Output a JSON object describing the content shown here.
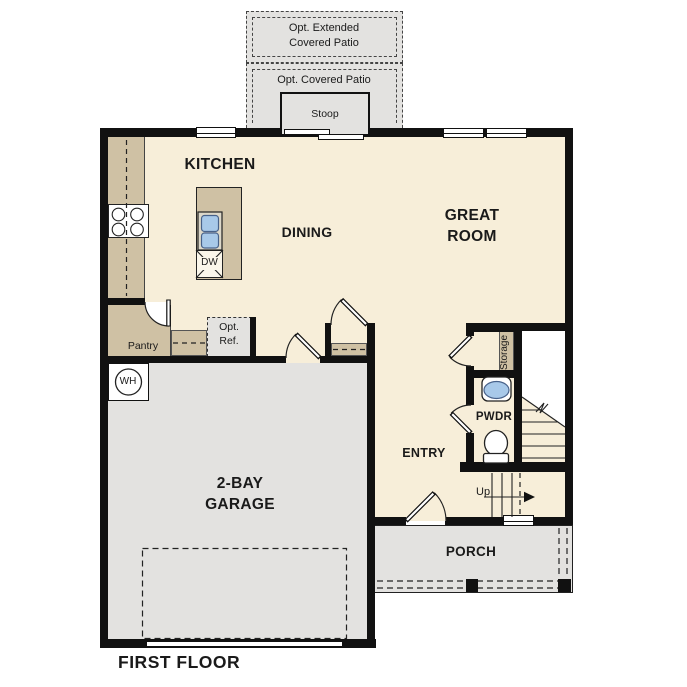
{
  "title": "FIRST FLOOR",
  "colors": {
    "floor": "#f7eed9",
    "paved": "#e3e2e0",
    "counter": "#cfc1a4",
    "wall": "#111111",
    "blue": "#a8c9e9"
  },
  "rooms": {
    "kitchen": "KITCHEN",
    "dining": "DINING",
    "great_room": "GREAT ROOM",
    "garage": "2-BAY GARAGE",
    "entry": "ENTRY",
    "pwdr": "PWDR",
    "pantry": "Pantry",
    "storage": "Storage",
    "porch": "PORCH"
  },
  "outdoor": {
    "opt_extended_patio": "Opt. Extended Covered Patio",
    "opt_covered_patio": "Opt. Covered Patio",
    "stoop": "Stoop"
  },
  "fixtures": {
    "water_heater": "WH",
    "dishwasher": "DW",
    "opt_ref": "Opt. Ref.",
    "stairs_up": "Up"
  }
}
